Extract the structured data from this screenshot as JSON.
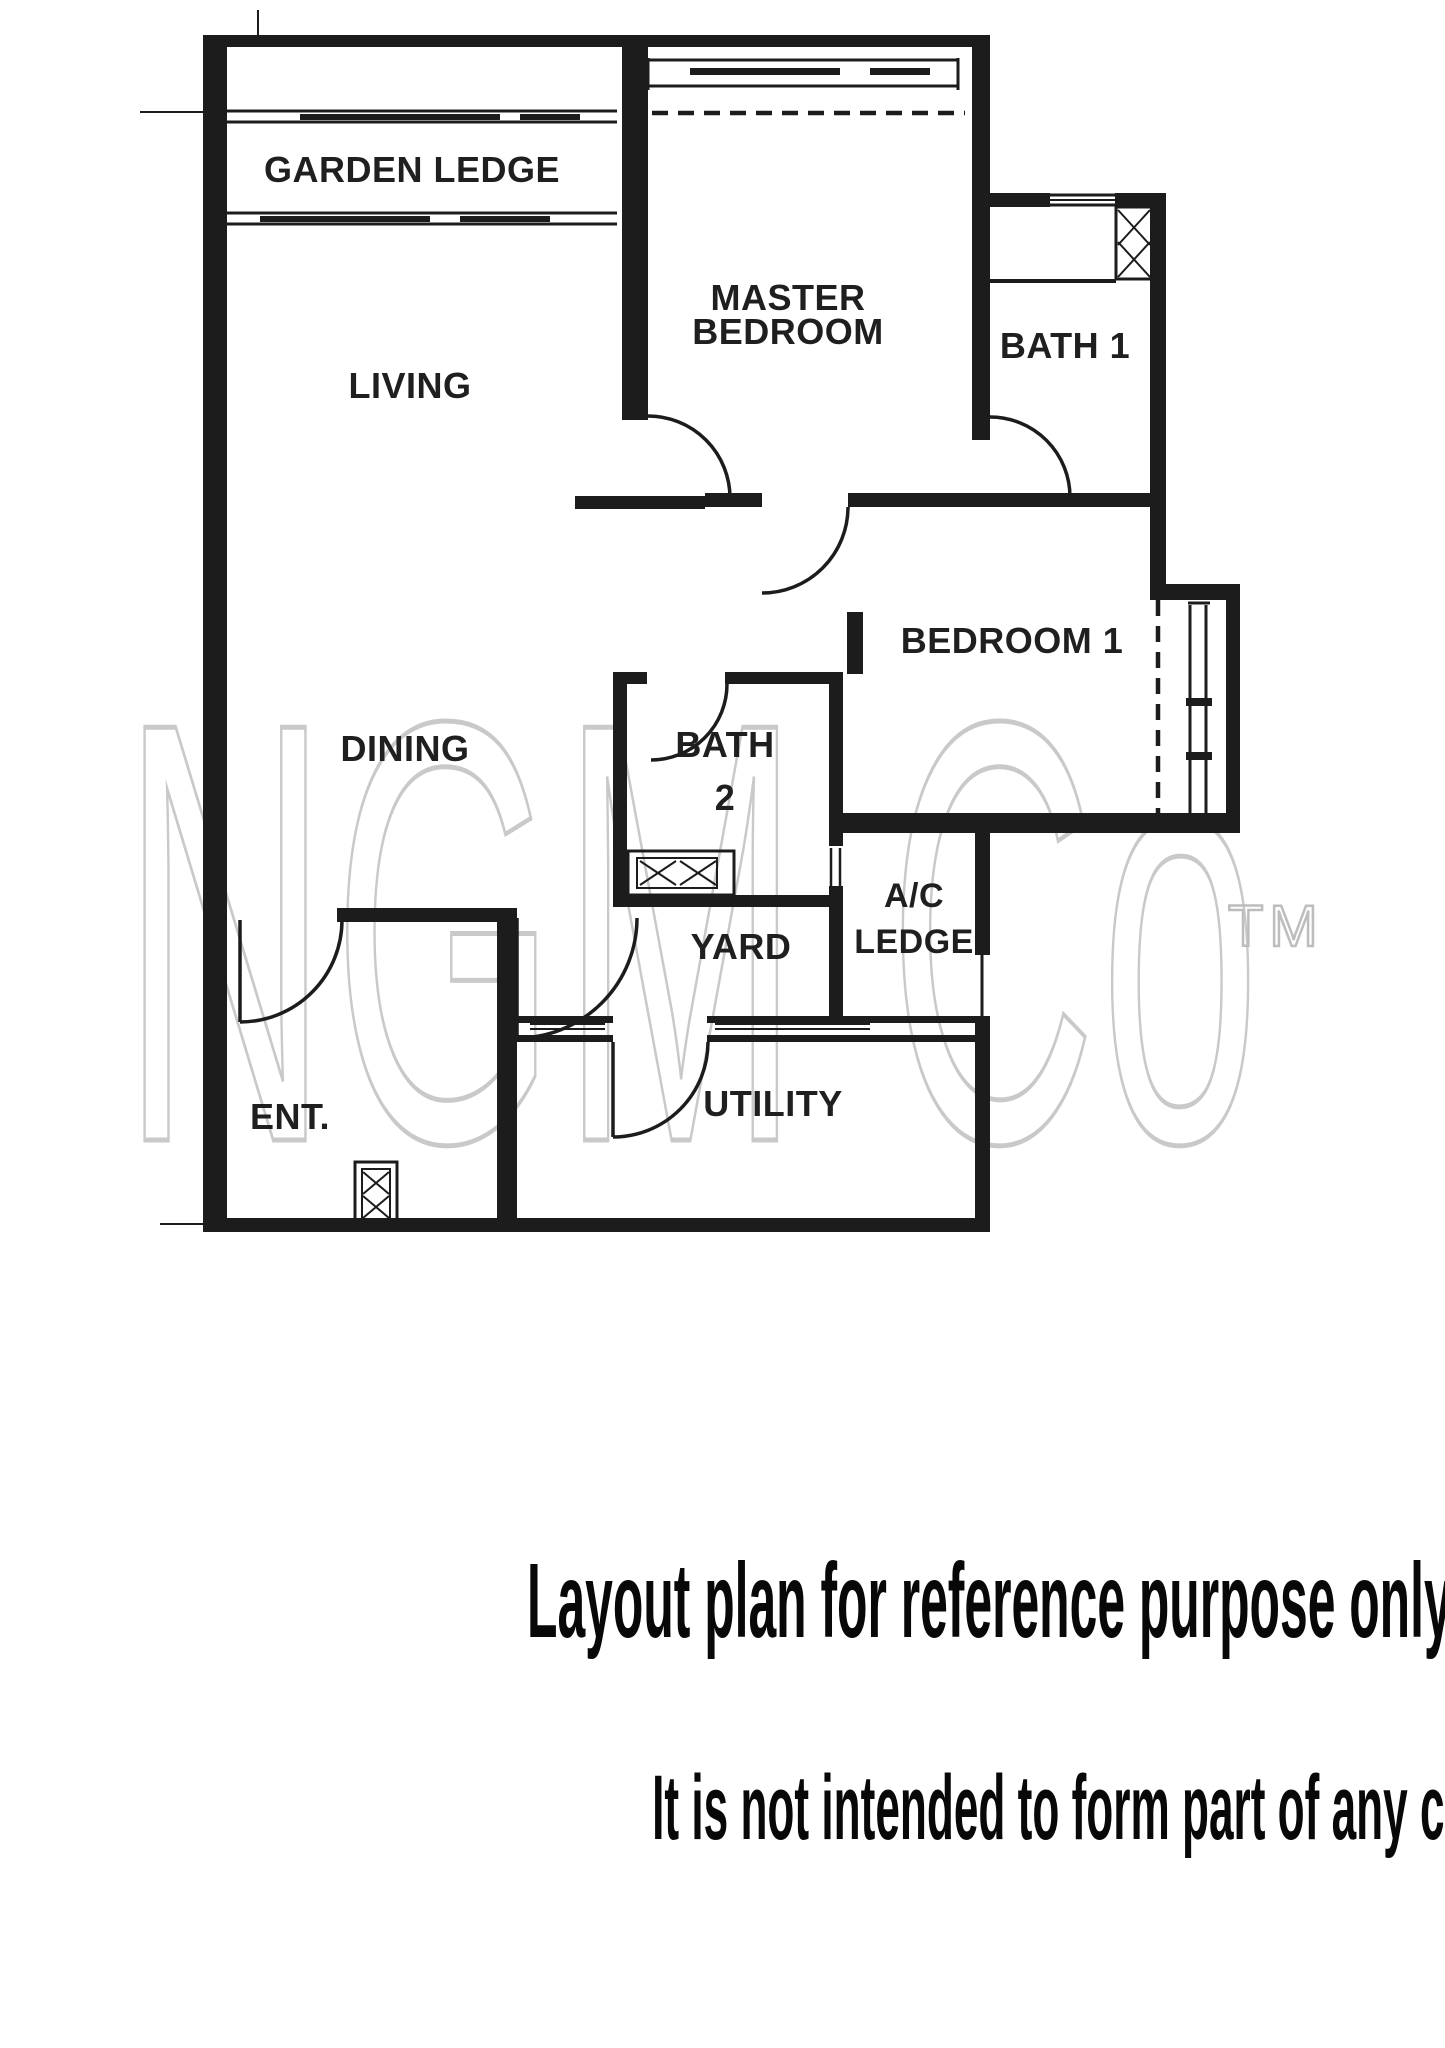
{
  "watermark": {
    "text": "NGM Co",
    "tm": "TM",
    "color": "#c9c9c9"
  },
  "plan": {
    "labels": {
      "garden_ledge": "GARDEN LEDGE",
      "living": "LIVING",
      "master_line1": "MASTER",
      "master_line2": "BEDROOM",
      "bath1": "BATH 1",
      "dining": "DINING",
      "bath2_line1": "BATH",
      "bath2_line2": "2",
      "bedroom1": "BEDROOM 1",
      "ac_line1": "A/C",
      "ac_line2": "LEDGE",
      "yard": "YARD",
      "ent": "ENT.",
      "utility": "UTILITY"
    }
  },
  "captions": {
    "line1": "Layout plan for reference purpose only.",
    "line2": "It is not intended to form part of any contract or warranty."
  },
  "colors": {
    "wall": "#1c1c1c",
    "background": "#ffffff",
    "watermark": "#c9c9c9",
    "caption_text": "#080808"
  }
}
